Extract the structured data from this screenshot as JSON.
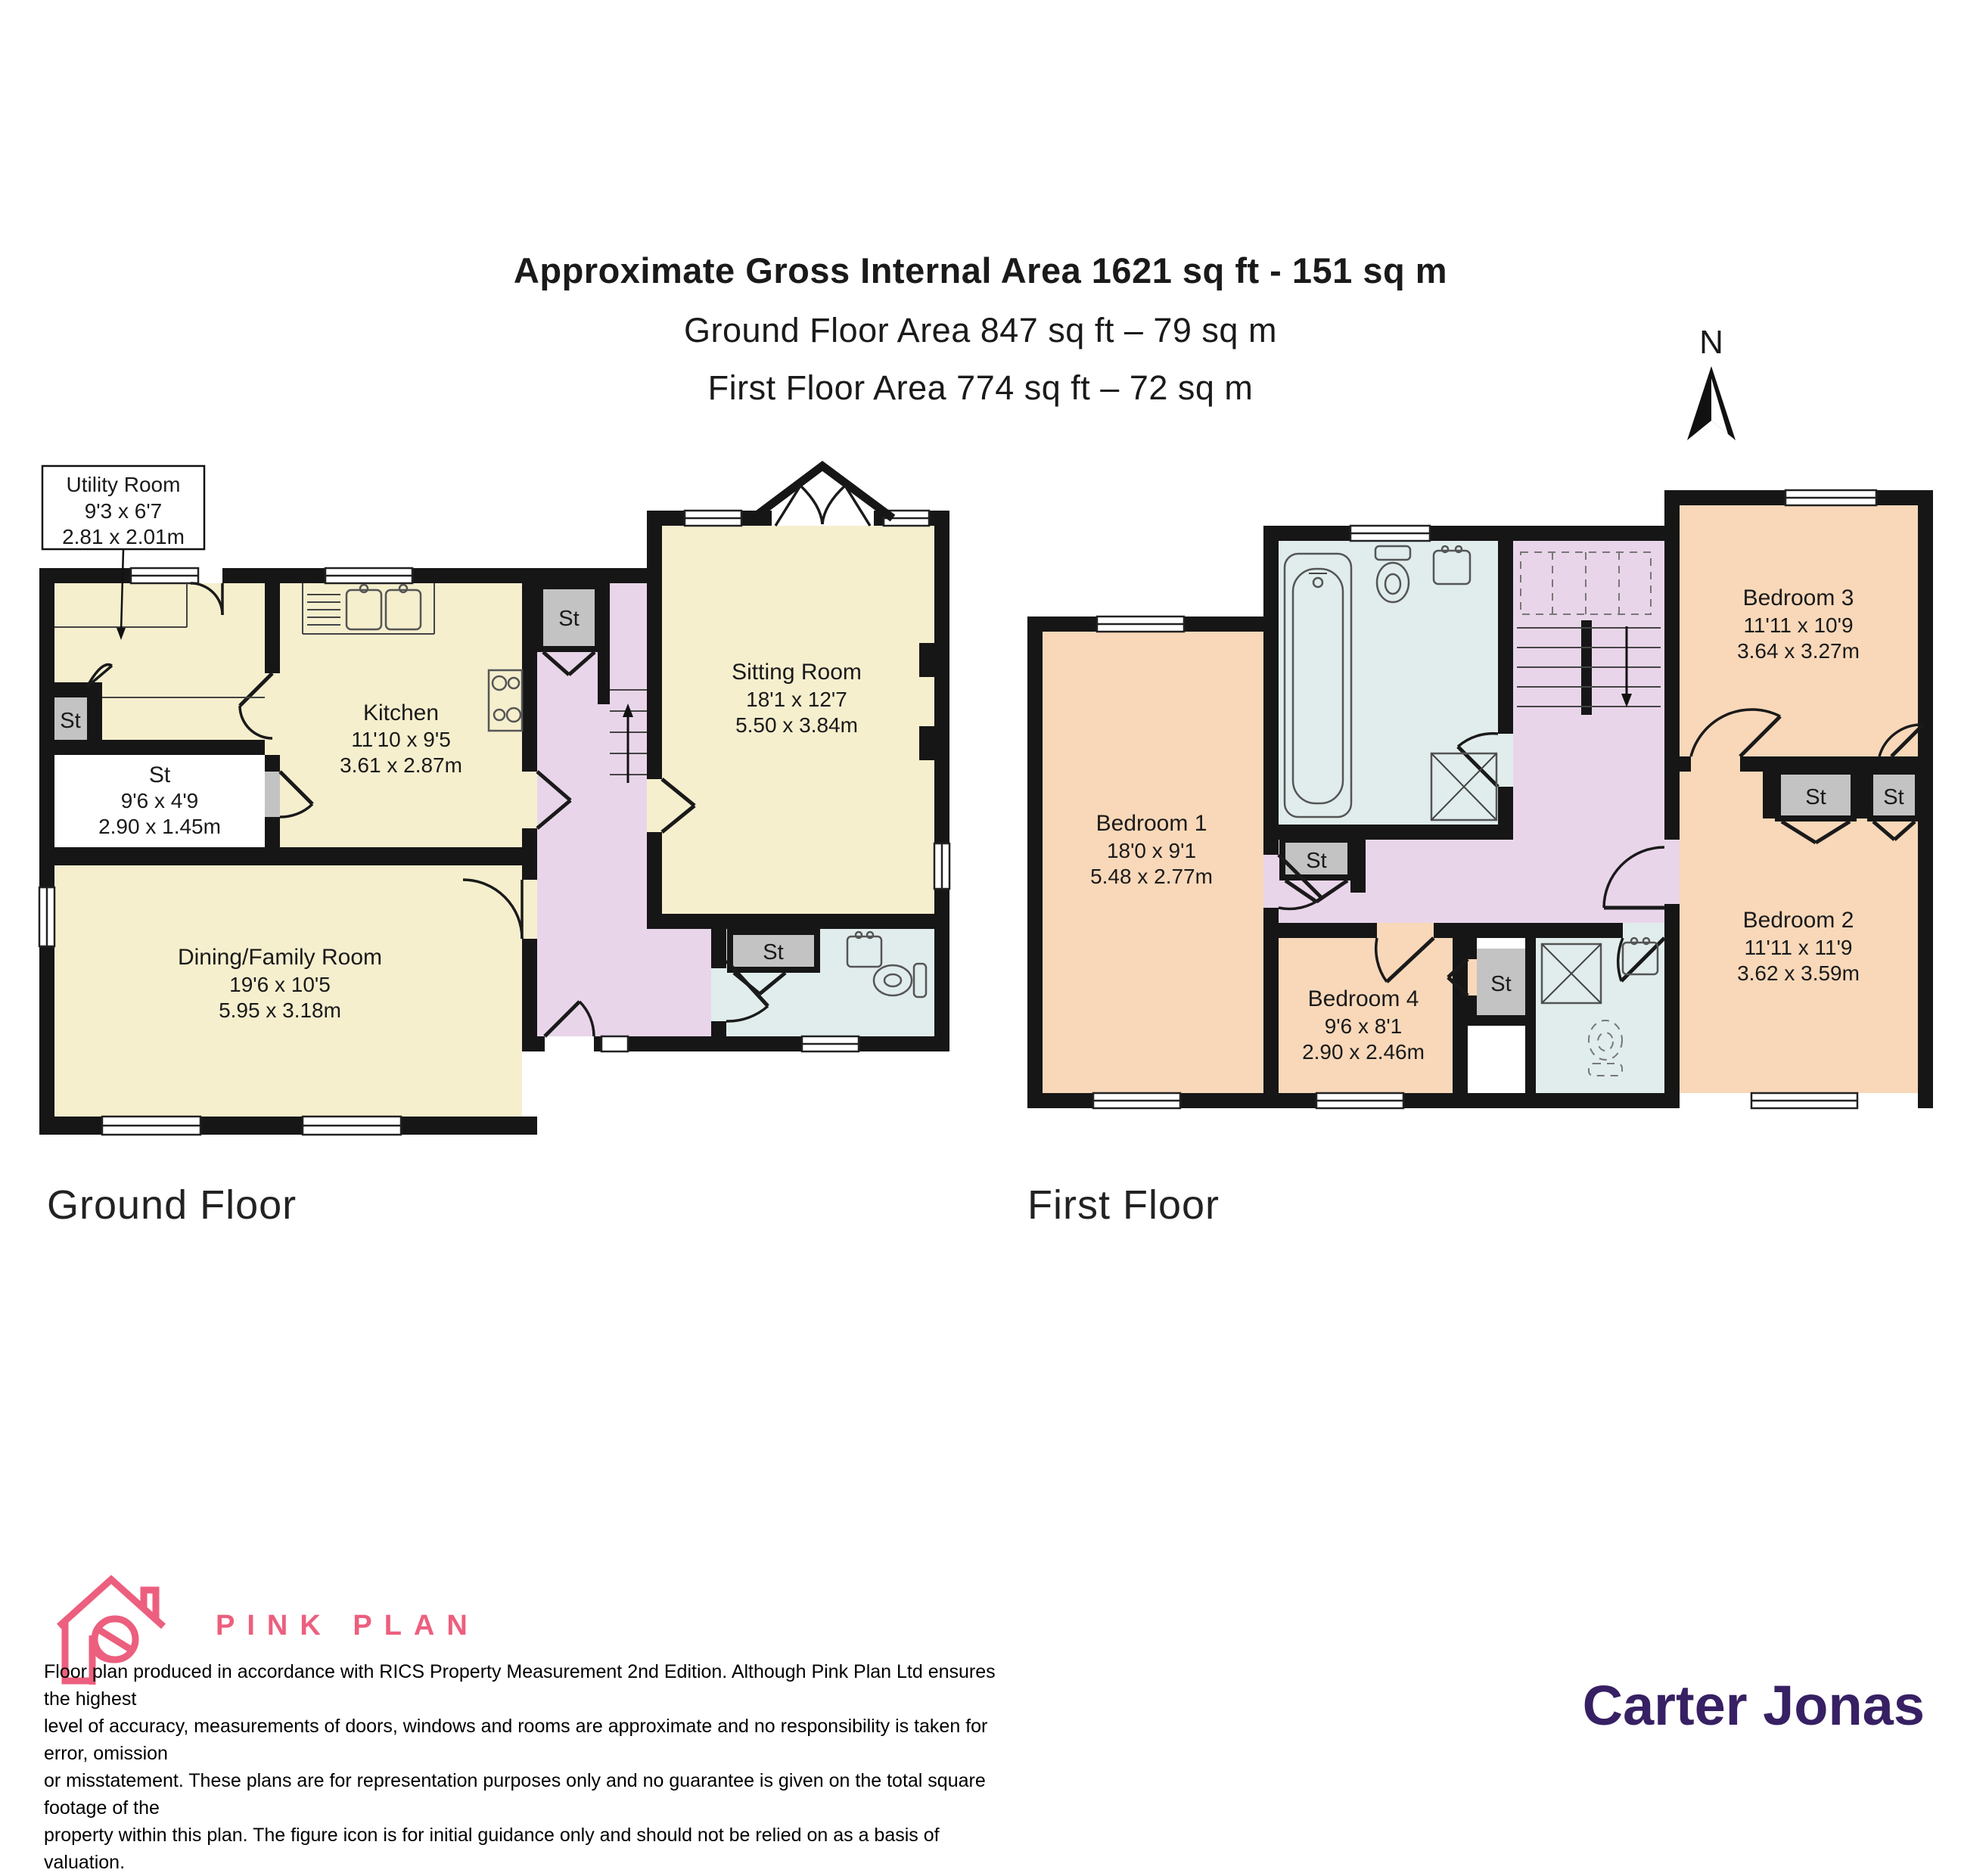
{
  "header": {
    "title": "Approximate Gross Internal Area 1621 sq ft - 151 sq m",
    "subtitle_ground": "Ground Floor Area 847 sq ft – 79 sq m",
    "subtitle_first": "First Floor Area 774 sq ft – 72 sq m",
    "north_label": "N"
  },
  "labels": {
    "st": "St"
  },
  "ground": {
    "floor_label": "Ground Floor",
    "utility": {
      "name": "Utility Room",
      "ft": "9'3 x 6'7",
      "m": "2.81 x 2.01m"
    },
    "storage": {
      "name": "St",
      "ft": "9'6 x 4'9",
      "m": "2.90 x 1.45m"
    },
    "kitchen": {
      "name": "Kitchen",
      "ft": "11'10 x 9'5",
      "m": "3.61 x 2.87m"
    },
    "sitting": {
      "name": "Sitting Room",
      "ft": "18'1 x 12'7",
      "m": "5.50 x 3.84m"
    },
    "dining": {
      "name": "Dining/Family Room",
      "ft": "19'6 x 10'5",
      "m": "5.95 x 3.18m"
    }
  },
  "first": {
    "floor_label": "First Floor",
    "bedroom1": {
      "name": "Bedroom 1",
      "ft": "18'0 x 9'1",
      "m": "5.48 x 2.77m"
    },
    "bedroom2": {
      "name": "Bedroom 2",
      "ft": "11'11 x 11'9",
      "m": "3.62 x 3.59m"
    },
    "bedroom3": {
      "name": "Bedroom 3",
      "ft": "11'11 x 10'9",
      "m": "3.64 x 3.27m"
    },
    "bedroom4": {
      "name": "Bedroom 4",
      "ft": "9'6 x 8'1",
      "m": "2.90 x 2.46m"
    }
  },
  "footer": {
    "brand": "PINK PLAN",
    "agency": "Carter Jonas",
    "disclaimer_lines": [
      "Floor plan produced in accordance with RICS Property Measurement 2nd Edition. Although Pink Plan Ltd ensures the highest",
      "level of accuracy, measurements of doors, windows and rooms are approximate and no responsibility is taken for error, omission",
      "or misstatement. These plans are for representation purposes only and no guarantee is given on the total square footage of the",
      "property within this plan. The figure icon is for initial guidance only and should not be relied on as a basis of valuation."
    ]
  },
  "colors": {
    "room_cream": "#f5efce",
    "room_peach": "#f8d8b9",
    "hall_lavender": "#e9d5e9",
    "bath_blue": "#e0edec",
    "storage_gray": "#c3c3c3",
    "wall_black": "#161616",
    "brand_pink": "#ec5f7e",
    "agency_purple": "#372063"
  }
}
